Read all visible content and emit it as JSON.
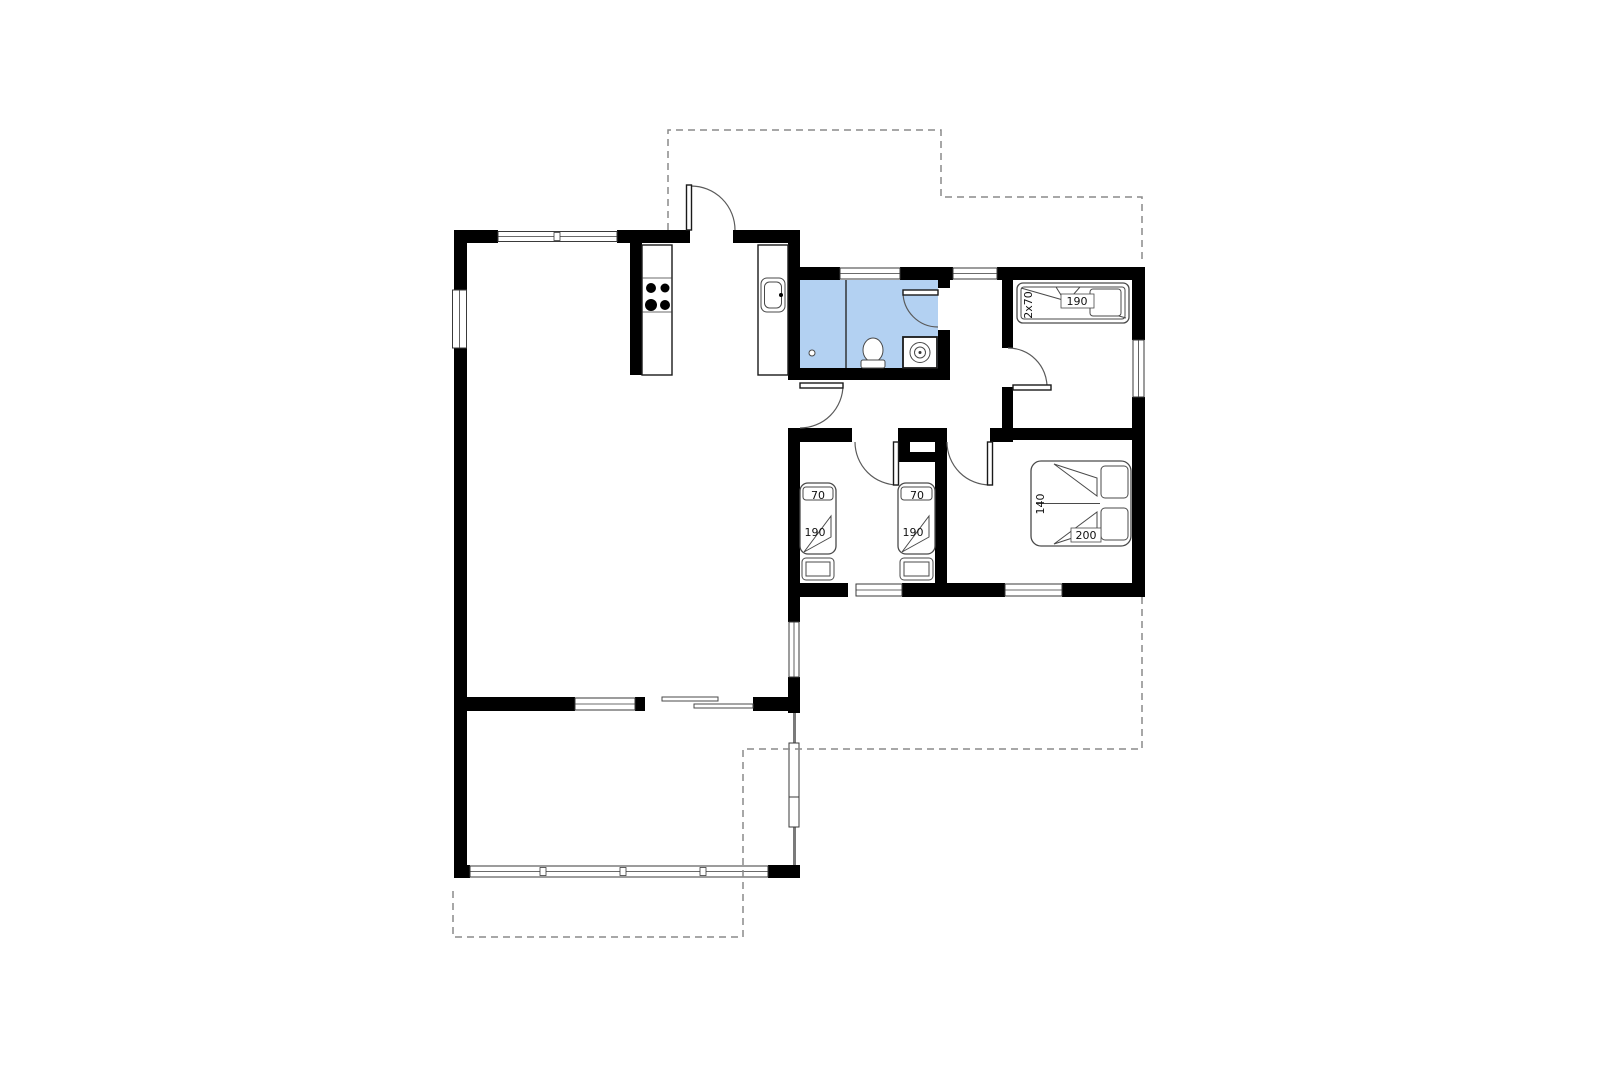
{
  "plan": {
    "background": "#ffffff",
    "wall_color": "#000000",
    "bathroom_fill": "#b3d1f2",
    "dashed_color": "#8a8a8a",
    "furniture_stroke": "#4a4a4a"
  },
  "rooms": {
    "bunk_room": {
      "bed_width_label": "2x70",
      "bed_length_label": "190"
    },
    "kids_room": {
      "bed1_width_label": "70",
      "bed1_length_label": "190",
      "bed2_width_label": "70",
      "bed2_length_label": "190"
    },
    "double_room": {
      "bed_width_label": "140",
      "bed_length_label": "200"
    }
  }
}
